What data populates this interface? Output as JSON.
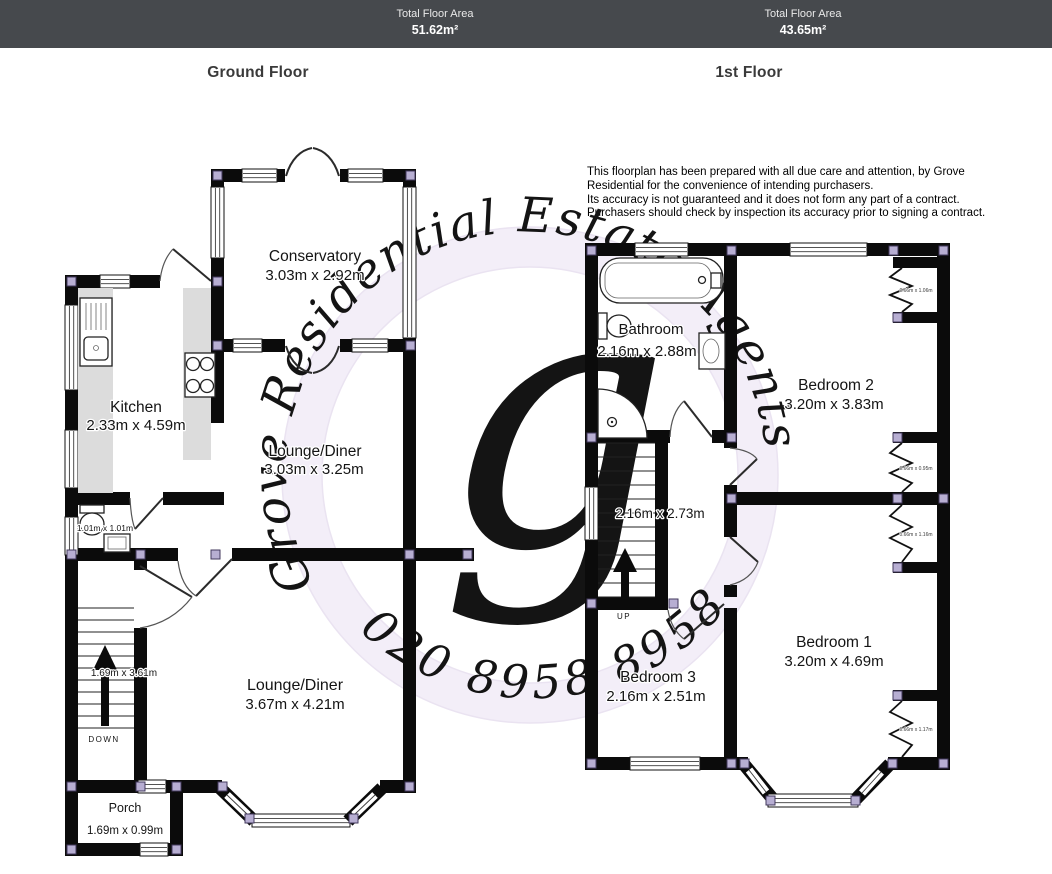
{
  "header": {
    "left": {
      "label": "Total Floor Area",
      "value": "51.62m²"
    },
    "right": {
      "label": "Total Floor Area",
      "value": "43.65m²"
    }
  },
  "titles": {
    "ground": "Ground Floor",
    "first": "1st Floor"
  },
  "disclaimer": {
    "line1": "This floorplan has been prepared with all due care and attention, by Grove Residential for the convenience of intending purchasers.",
    "line2": "Its accuracy is not guaranteed and it does not form any part of a contract. Purchasers should check by inspection its accuracy prior to signing a contract."
  },
  "watermark": {
    "brand": "Grove Residential Estate Agents",
    "phone": "020 8958 8958",
    "monogram": "g"
  },
  "ground": {
    "conservatory": {
      "name": "Conservatory",
      "dims": "3.03m x 2.92m"
    },
    "kitchen": {
      "name": "Kitchen",
      "dims": "2.33m x 4.59m"
    },
    "lounge_diner_rear": {
      "name": "Lounge/Diner",
      "dims": "3.03m x 3.25m"
    },
    "lounge_diner_front": {
      "name": "Lounge/Diner",
      "dims": "3.67m x 4.21m"
    },
    "wc": {
      "dims": "1.01m x 1.01m"
    },
    "hall": {
      "stairs_dims": "1.69m x 3.61m",
      "direction": "DOWN"
    },
    "porch": {
      "name": "Porch",
      "dims": "1.69m x 0.99m"
    }
  },
  "first": {
    "bathroom": {
      "name": "Bathroom",
      "dims": "2.16m x 2.88m"
    },
    "bedroom2": {
      "name": "Bedroom 2",
      "dims": "3.20m x 3.83m"
    },
    "landing": {
      "dims": "2.16m x 2.73m",
      "direction": "UP"
    },
    "bedroom3": {
      "name": "Bedroom 3",
      "dims": "2.16m x 2.51m"
    },
    "bedroom1": {
      "name": "Bedroom 1",
      "dims": "3.20m x 4.69m"
    },
    "alcove1": "0.66m x 1.06m",
    "alcove2": "0.66m x 0.95m",
    "alcove3": "0.66m x 1.16m",
    "alcove4": "0.66m x 1.17m"
  },
  "colors": {
    "header_bg": "#46494d",
    "wall": "#0b0b0b",
    "corner_node": "#b7aed2",
    "counter": "#dcdcdc",
    "watermark_tint": "#efe8f5"
  }
}
